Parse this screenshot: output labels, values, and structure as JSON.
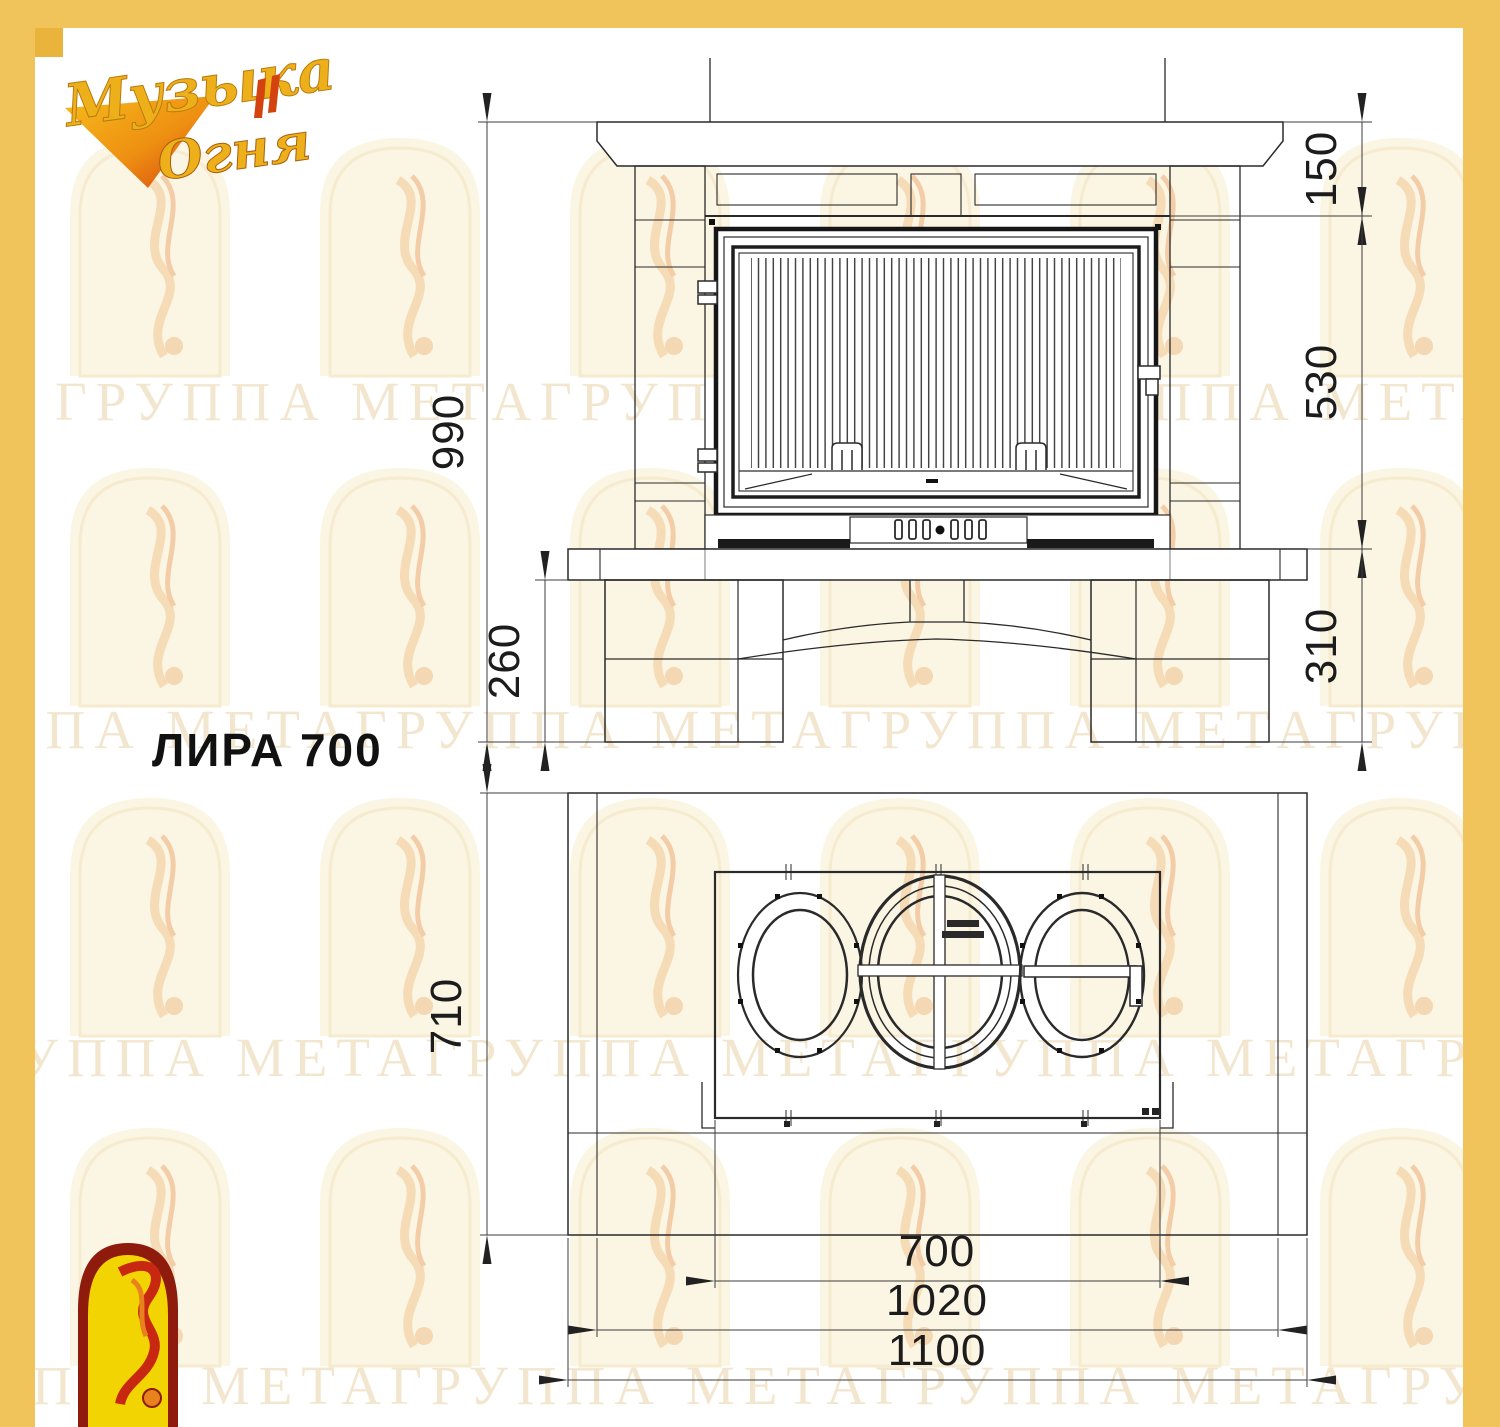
{
  "page": {
    "border_color": "#f1c35b",
    "border_accent": "#eab33c",
    "paper_color": "#ffffff",
    "line_color": "#2a2a2a"
  },
  "brand_logo": {
    "line1": "Музыка",
    "line2": "Огня",
    "gold": "#edb01a",
    "red": "#d4420f"
  },
  "drawing": {
    "title": "ЛИРА 700"
  },
  "watermark": {
    "text": "ГРУППА МЕТАГРУППА МЕТАГРУППА МЕТАГРУППА МЕТА",
    "color": "#e9d2a8"
  },
  "front_view": {
    "dims": {
      "total_height": "990",
      "mantel_height": "150",
      "firebox_height": "530",
      "base_height": "310",
      "plinth_height": "260"
    }
  },
  "plan_view": {
    "dims": {
      "depth": "710",
      "insert_width": "700",
      "inner_width": "1020",
      "total_width": "1100"
    }
  }
}
